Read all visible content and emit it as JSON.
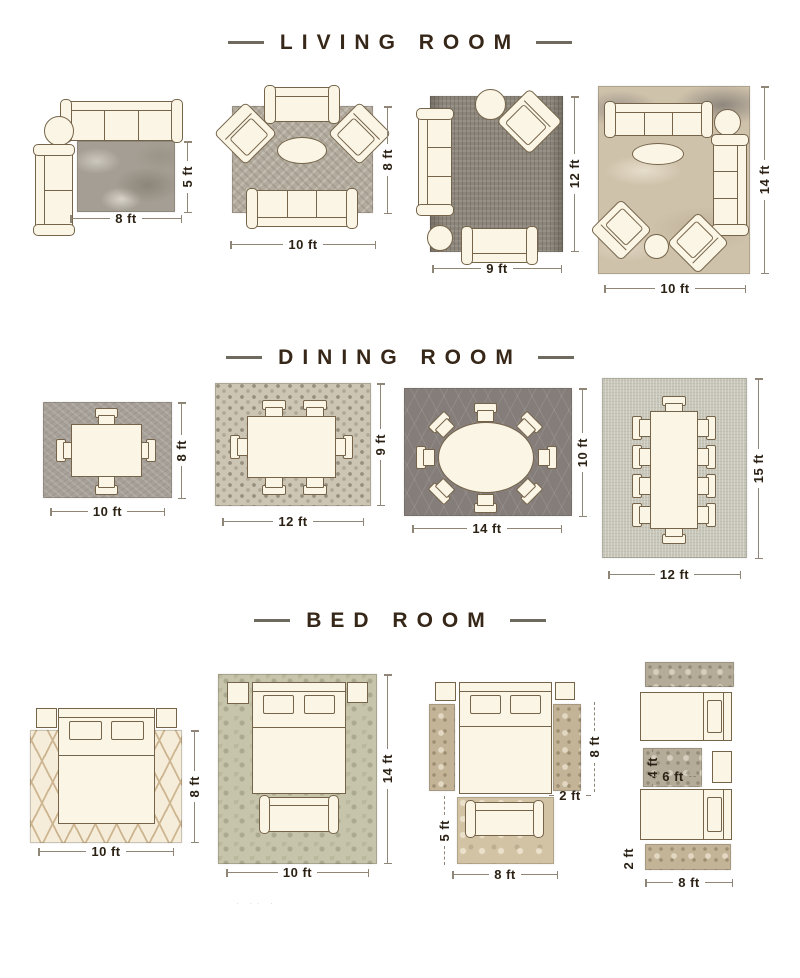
{
  "colors": {
    "furniture_outline": "#75644a",
    "furniture_fill": "#fbf5e5",
    "dimension_text": "#2b2114",
    "dimension_line": "#8f8678",
    "title_text": "#362718"
  },
  "sections": [
    {
      "title": "LIVING ROOM",
      "layouts": [
        {
          "width": "8 ft",
          "height": "5 ft"
        },
        {
          "width": "10 ft",
          "height": "8 ft"
        },
        {
          "width": "9 ft",
          "height": "12 ft"
        },
        {
          "width": "10 ft",
          "height": "14 ft"
        }
      ]
    },
    {
      "title": "DINING ROOM",
      "layouts": [
        {
          "width": "10 ft",
          "height": "8 ft"
        },
        {
          "width": "12 ft",
          "height": "9 ft"
        },
        {
          "width": "14 ft",
          "height": "10 ft"
        },
        {
          "width": "12 ft",
          "height": "15 ft"
        }
      ]
    },
    {
      "title": "BED ROOM",
      "layouts": [
        {
          "width": "10 ft",
          "height": "8 ft"
        },
        {
          "width": "10 ft",
          "height": "14 ft"
        },
        {
          "width": "8 ft",
          "side_runner_length": "8 ft",
          "side_runner_width": "2 ft",
          "foot_rug_height": "5 ft"
        },
        {
          "width": "8 ft",
          "runner_height": "2 ft",
          "accent_rug_height": "4 ft",
          "accent_rug_width": "6 ft"
        }
      ]
    }
  ],
  "watermark": "· ·· ·"
}
